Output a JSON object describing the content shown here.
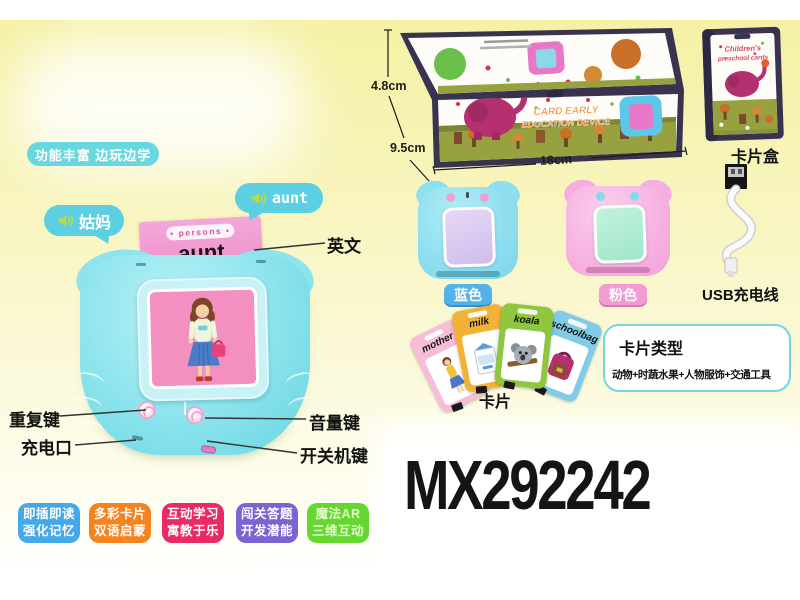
{
  "colors": {
    "background_yellow": "#f5f1a4",
    "bubble_cyan": "#5ccfe2",
    "pill_cyan": "#69d8de",
    "flash_card_pink": "#f0a0d2",
    "device_teal": "#7edee8",
    "screen_pink": "#f48fc2",
    "box_frame_navy": "#3a3350",
    "grass_green": "#97a13f",
    "elephant_magenta": "#b5306e",
    "types_border_cyan": "#74d6e2"
  },
  "header": {
    "feature_pill": "功能丰富 边玩边学"
  },
  "speech": {
    "chinese_word": "姑妈",
    "english_word": "aunt"
  },
  "flash_card": {
    "category": "• persons •",
    "word": "aunt"
  },
  "callouts": {
    "english": "英文",
    "repeat_key": "重复键",
    "charging_port": "充电口",
    "volume_key": "音量键",
    "power_key": "开关机键"
  },
  "package_box": {
    "height_label": "4.8cm",
    "depth_label": "9.5cm",
    "width_label": "18cm",
    "art_title_line1": "CARD EARLY",
    "art_title_line2": "EDUCATION DEVICE"
  },
  "card_box": {
    "label": "卡片盒",
    "art_line1": "Children's",
    "art_line2": "preschool cards"
  },
  "usb": {
    "label": "USB充电线"
  },
  "variants": {
    "blue": "蓝色",
    "pink": "粉色",
    "blue_bg": "#52b2ea",
    "pink_bg": "#f49ad4"
  },
  "fan_cards": {
    "label": "卡片",
    "items": [
      {
        "word": "mother",
        "color": "#f6bcd8"
      },
      {
        "word": "milk",
        "color": "#f2b236"
      },
      {
        "word": "koala",
        "color": "#8ec63f"
      },
      {
        "word": "schoolbag",
        "color": "#80cce8"
      }
    ]
  },
  "card_types": {
    "title": "卡片类型",
    "description": "动物+时蔬水果+人物服饰+交通工具"
  },
  "model_number": "MX292242",
  "feature_badges": [
    {
      "line1": "即插即读",
      "line2": "强化记忆",
      "bg": "#45a8e8",
      "fg": "#ffffff"
    },
    {
      "line1": "多彩卡片",
      "line2": "双语启蒙",
      "bg": "#f5831f",
      "fg": "#ffffff"
    },
    {
      "line1": "互动学习",
      "line2": "寓教于乐",
      "bg": "#ea2a62",
      "fg": "#ffffff"
    },
    {
      "line1": "闯关答题",
      "line2": "开发潜能",
      "bg": "#7d63d2",
      "fg": "#ffffff"
    },
    {
      "line1": "魔法AR",
      "line2": "三维互动",
      "bg": "#64d830",
      "fg": "#e4f8cc"
    }
  ]
}
